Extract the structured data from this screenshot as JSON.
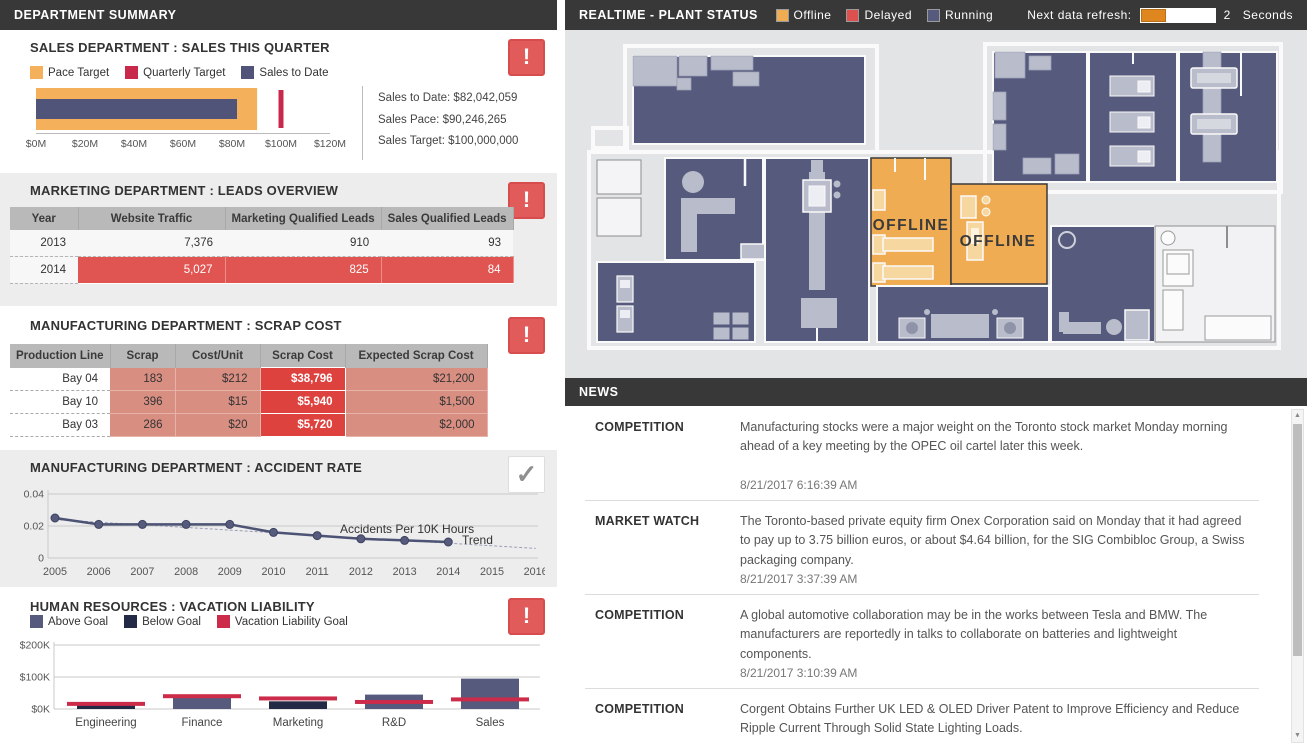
{
  "left": {
    "header": "DEPARTMENT SUMMARY",
    "marketing": {
      "title": "MARKETING DEPARTMENT : LEADS OVERVIEW",
      "table": {
        "headers": [
          "Year",
          "Website Traffic",
          "Marketing Qualified Leads",
          "Sales Qualified Leads"
        ],
        "rows": [
          {
            "year": "2013",
            "values": [
              "7,376",
              "910",
              "93"
            ],
            "highlight": false
          },
          {
            "year": "2014",
            "values": [
              "5,027",
              "825",
              "84"
            ],
            "highlight": true
          }
        ]
      }
    },
    "scrap": {
      "title": "MANUFACTURING DEPARTMENT : SCRAP COST",
      "table": {
        "headers": [
          "Production Line",
          "Scrap",
          "Cost/Unit",
          "Scrap Cost",
          "Expected Scrap Cost"
        ],
        "rows": [
          {
            "line": "Bay 04",
            "scrap": "183",
            "cost_unit": "$212",
            "scrap_cost": "$38,796",
            "expected": "$21,200"
          },
          {
            "line": "Bay 10",
            "scrap": "396",
            "cost_unit": "$15",
            "scrap_cost": "$5,940",
            "expected": "$1,500"
          },
          {
            "line": "Bay 03",
            "scrap": "286",
            "cost_unit": "$20",
            "scrap_cost": "$5,720",
            "expected": "$2,000"
          }
        ]
      }
    }
  },
  "chart_data": [
    {
      "type": "bar",
      "variant": "bullet",
      "title": "SALES DEPARTMENT : SALES THIS QUARTER",
      "legend": [
        {
          "label": "Pace Target",
          "color": "#f4b05a"
        },
        {
          "label": "Quarterly Target",
          "color": "#c8294a"
        },
        {
          "label": "Sales to Date",
          "color": "#4f5478"
        }
      ],
      "measures": {
        "sales_to_date": 82.042059,
        "sales_pace": 90.246265,
        "sales_target": 100
      },
      "unit": "$M",
      "xlim": [
        0,
        120
      ],
      "x_ticks": [
        "$0M",
        "$20M",
        "$40M",
        "$60M",
        "$80M",
        "$100M",
        "$120M"
      ],
      "stats": [
        "Sales to Date: $82,042,059",
        "Sales Pace: $90,246,265",
        "Sales Target: $100,000,000"
      ]
    },
    {
      "type": "line",
      "title": "MANUFACTURING DEPARTMENT : ACCIDENT RATE",
      "x": [
        2005,
        2006,
        2007,
        2008,
        2009,
        2010,
        2011,
        2012,
        2013,
        2014
      ],
      "values": [
        0.025,
        0.021,
        0.021,
        0.021,
        0.021,
        0.016,
        0.014,
        0.012,
        0.011,
        0.01
      ],
      "trend": {
        "x": [
          2005,
          2016
        ],
        "values": [
          0.024,
          0.006
        ]
      },
      "x_ticks": [
        "2005",
        "2006",
        "2007",
        "2008",
        "2009",
        "2010",
        "2011",
        "2012",
        "2013",
        "2014",
        "2015",
        "2016"
      ],
      "y_ticks": [
        "0",
        "0.02",
        "0.04"
      ],
      "ylim": [
        0,
        0.04
      ],
      "series_label": "Accidents Per 10K Hours",
      "trend_label": "Trend",
      "line_color": "#4d5374",
      "trend_color": "#9a9eb5"
    },
    {
      "type": "bar",
      "title": "HUMAN RESOURCES : VACATION LIABILITY",
      "legend": [
        {
          "label": "Above Goal",
          "color": "#565a7d"
        },
        {
          "label": "Below Goal",
          "color": "#232a45"
        },
        {
          "label": "Vacation Liability Goal",
          "color": "#cc2b49"
        }
      ],
      "categories": [
        "Engineering",
        "Finance",
        "Marketing",
        "R&D",
        "Sales"
      ],
      "series": [
        {
          "name": "Vacation Liability ($K)",
          "values": [
            12,
            35,
            24,
            45,
            95
          ]
        },
        {
          "name": "Vacation Liability Goal ($K)",
          "values": [
            16,
            40,
            33,
            22,
            30
          ]
        }
      ],
      "status": [
        "below",
        "above",
        "below",
        "above",
        "above"
      ],
      "y_ticks": [
        "$0K",
        "$100K",
        "$200K"
      ],
      "ylim": [
        0,
        200
      ]
    }
  ],
  "plant": {
    "header": "REALTIME - PLANT STATUS",
    "legend": [
      {
        "label": "Offline",
        "color": "#f0ac53"
      },
      {
        "label": "Delayed",
        "color": "#dd5050"
      },
      {
        "label": "Running",
        "color": "#565a7d"
      }
    ],
    "refresh_label": "Next data refresh:",
    "refresh_value": "2",
    "refresh_unit": "Seconds",
    "offline_label": "OFFLINE"
  },
  "news": {
    "header": "NEWS",
    "items": [
      {
        "category": "COMPETITION",
        "text": "Manufacturing stocks were a major weight on the Toronto stock market Monday morning ahead of a key meeting by the OPEC oil cartel later this week.",
        "timestamp": "8/21/2017 6:16:39 AM"
      },
      {
        "category": "MARKET WATCH",
        "text": "The Toronto-based private equity firm Onex Corporation said on Monday that it had agreed to pay up to 3.75 billion euros, or about $4.64 billion, for the SIG Combibloc Group, a Swiss packaging company.",
        "timestamp": "8/21/2017 3:37:39 AM"
      },
      {
        "category": "COMPETITION",
        "text": "A global automotive collaboration may be in the works between Tesla and BMW. The manufacturers are reportedly in talks to collaborate on batteries and lightweight components.",
        "timestamp": "8/21/2017 3:10:39 AM"
      },
      {
        "category": "COMPETITION",
        "text": "Corgent Obtains Further UK LED & OLED Driver Patent to Improve Efficiency and Reduce Ripple Current Through Solid State Lighting Loads.",
        "timestamp": ""
      }
    ]
  },
  "icons": {
    "alert": "!",
    "check": "✓",
    "scroll_up": "▲",
    "scroll_down": "▼"
  },
  "colors": {
    "header_bar": "#383838",
    "section_gray": "#ededed",
    "orange": "#f0ac53",
    "navy": "#565a7d",
    "dark_navy": "#232a45",
    "crimson": "#cc2b49",
    "alert_red": "#e15b5b",
    "table_row_red": "#e05551",
    "salmon": "#d98e82",
    "bright_red": "#de423f",
    "plant_bg": "#e3e4e6"
  }
}
